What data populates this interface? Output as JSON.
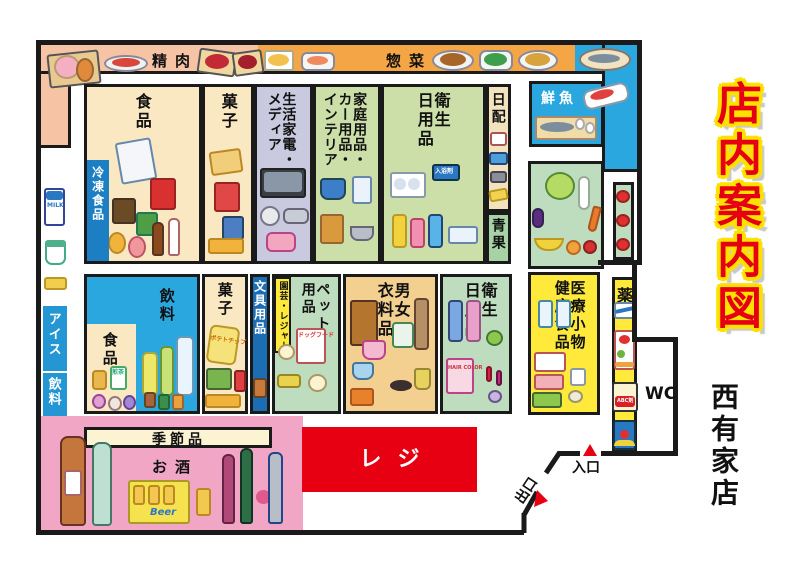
{
  "title": {
    "main": "店内案内図",
    "store": "西有家店"
  },
  "bands": {
    "meat": "精肉",
    "deli": "惣菜"
  },
  "sections": {
    "fish": "鮮魚",
    "food1": "食品",
    "frozen": "冷凍食品",
    "snacks1": "菓子",
    "electronics": [
      "生活家電・",
      "メディア"
    ],
    "household": [
      "家庭用品・",
      "カー用品・",
      "インテリア"
    ],
    "hygiene1": [
      "衛生",
      "日用品"
    ],
    "daily": "日配",
    "produce": "青果",
    "ice": "アイス",
    "drinks_wall": "飲料",
    "food2": "食品",
    "drinks2": "飲料",
    "snacks2": "菓子",
    "stationery": "文具用品",
    "garden": "園芸・レジャー",
    "pet": [
      "ペット",
      "用品"
    ],
    "clothing": [
      "男女",
      "衣料品"
    ],
    "hygiene2": [
      "衛生",
      "日用品"
    ],
    "medical": [
      "医療小物",
      "健康食品"
    ],
    "medicine": "薬"
  },
  "bottom": {
    "seasonal": "季節品",
    "alcohol": "お酒",
    "register": "レジ"
  },
  "doors": {
    "entrance": "入口",
    "exit": "出口",
    "wc": "WC"
  },
  "products": {
    "milk": "MILK",
    "beer": "Beer",
    "tea": "煎茶",
    "bath_salt": "入浴剤",
    "abc": "ABC剤",
    "hair": "HAIR COLOR",
    "chips": "ポテトチップ",
    "dogfood": "ドッグフード"
  },
  "colors": {
    "wall": "#1a1a1a",
    "meat_band": "#F6C3A5",
    "deli_band": "#F4A545",
    "blue_area": "#2BA7E0",
    "label_blue": "#1C7FC4",
    "cream": "#F9E8C2",
    "lavender": "#C9CADF",
    "green_warm": "#CCDFA8",
    "green_cool": "#BEDCBE",
    "tan": "#F2E3BE",
    "clothing_tan": "#F3CF90",
    "yellow": "#FFE93B",
    "seasonal_cream": "#FBF3D2",
    "alcohol_pink": "#F2A6C6",
    "register_red": "#E60012",
    "title_red": "#E50012",
    "title_outline": "#FFE100"
  }
}
